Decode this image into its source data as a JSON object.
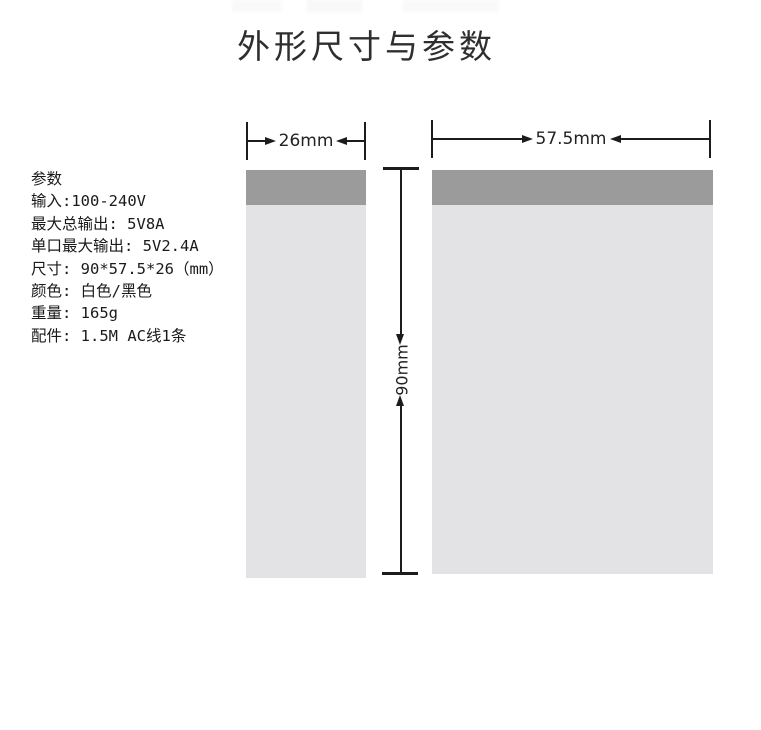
{
  "title": "外形尺寸与参数",
  "specs": {
    "heading": "参数",
    "lines": [
      "输入:100-240V",
      "最大总输出: 5V8A",
      "单口最大输出: 5V2.4A",
      "尺寸: 90*57.5*26（mm）",
      "颜色: 白色/黑色",
      "重量: 165g",
      "配件: 1.5M AC线1条"
    ]
  },
  "diagram": {
    "side_view": {
      "width_label": "26mm"
    },
    "front_view": {
      "width_label": "57.5mm"
    },
    "height_label": "90mm"
  },
  "theme": {
    "bg": "#ffffff",
    "band": "#9b9b9b",
    "panel": "#e3e3e6",
    "line": "#1c1c1c",
    "ink": "#1a1a1a",
    "dimink": "#222222",
    "titleink": "#2e2e2e"
  }
}
